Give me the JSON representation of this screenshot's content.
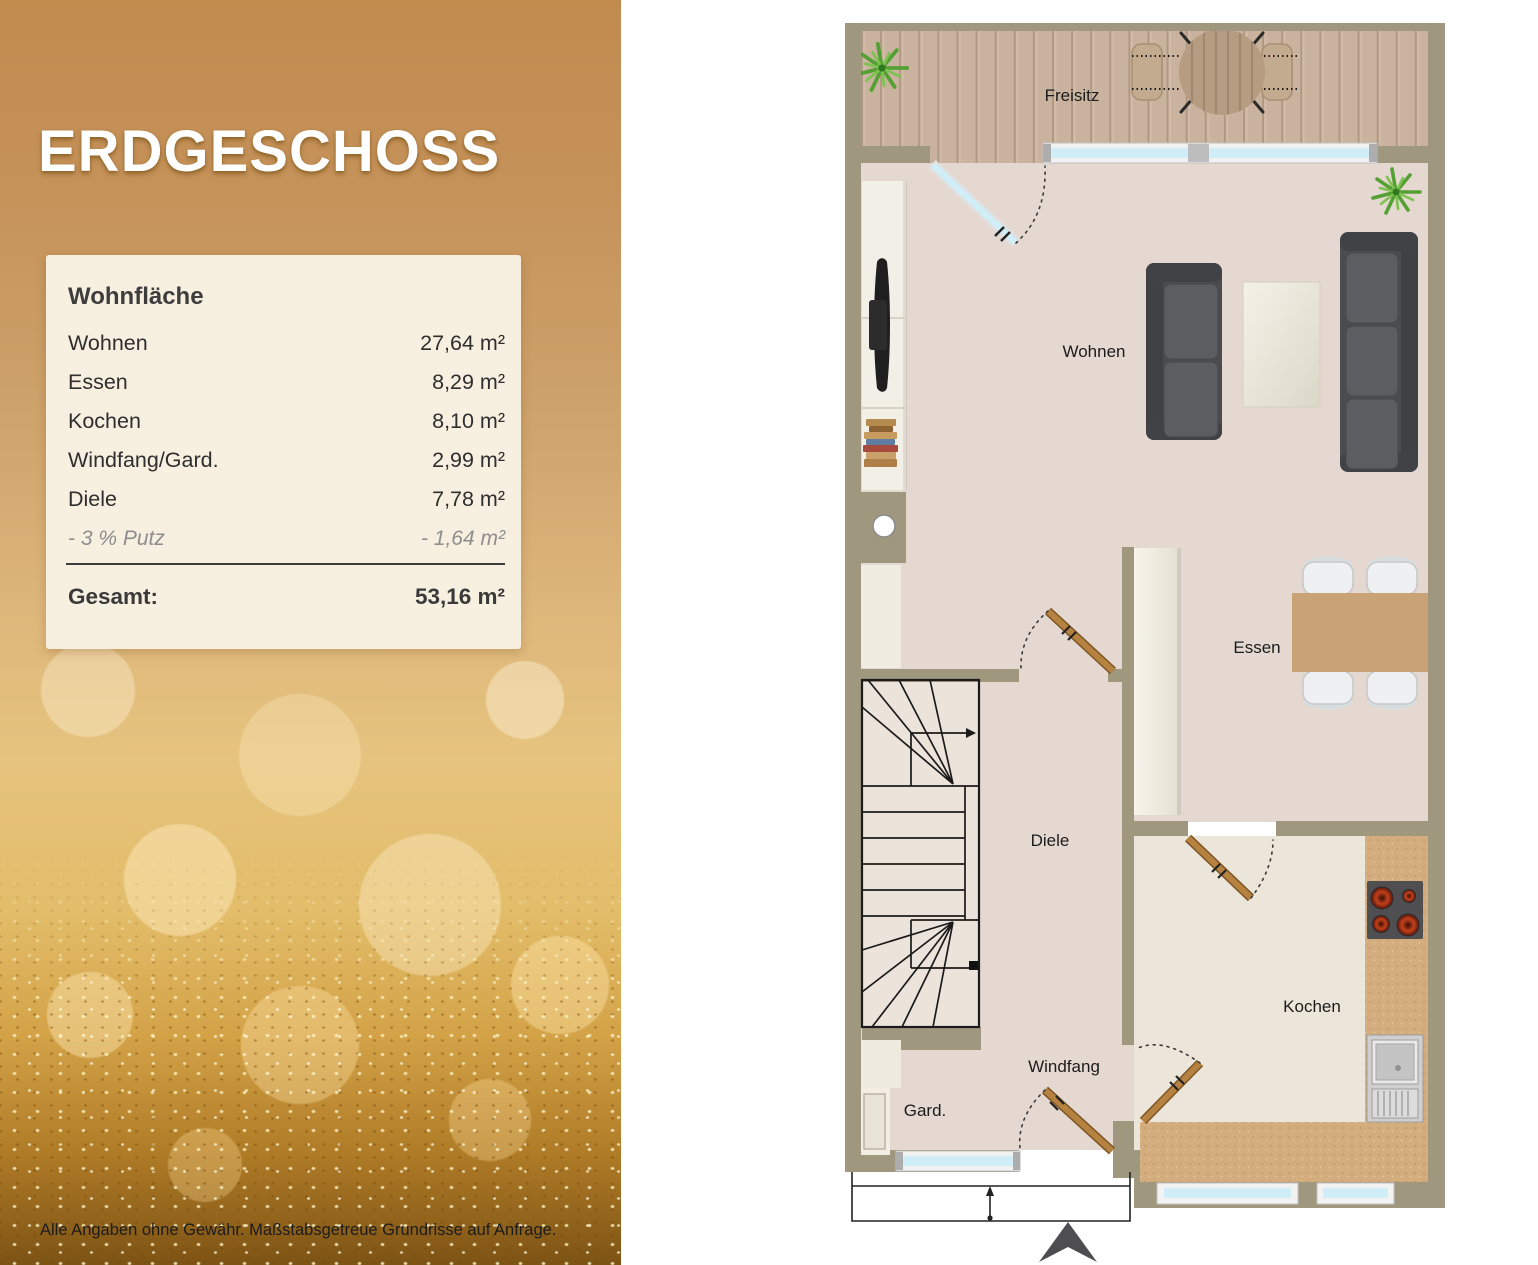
{
  "panel": {
    "title": "ERDGESCHOSS",
    "disclaimer": "Alle Angaben ohne Gewähr. Maßstabsgetreue Grundrisse auf Anfrage."
  },
  "area_table": {
    "heading": "Wohnfläche",
    "rows": [
      {
        "label": "Wohnen",
        "value": "27,64 m²"
      },
      {
        "label": "Essen",
        "value": "8,29 m²"
      },
      {
        "label": "Kochen",
        "value": "8,10 m²"
      },
      {
        "label": "Windfang/Gard.",
        "value": "2,99 m²"
      },
      {
        "label": "Diele",
        "value": "7,78 m²"
      }
    ],
    "deduction": {
      "label": "- 3 % Putz",
      "value": "- 1,64 m²"
    },
    "total": {
      "label": "Gesamt:",
      "value": "53,16 m²"
    }
  },
  "floorplan": {
    "labels": {
      "freisitz": "Freisitz",
      "wohnen": "Wohnen",
      "essen": "Essen",
      "diele": "Diele",
      "kochen": "Kochen",
      "windfang": "Windfang",
      "garderobe": "Gard."
    },
    "colors": {
      "wall": "#a0977f",
      "floor": "#e4d8d0",
      "kitchen_floor": "#ece5da",
      "stair_floor": "#ece3da",
      "deck_wood": "#c9b39e",
      "counter": "#d4ad7f",
      "door_wood": "#b5823f",
      "window_glass": "#cfeef7",
      "accent_gold": "#c18b4e"
    }
  }
}
